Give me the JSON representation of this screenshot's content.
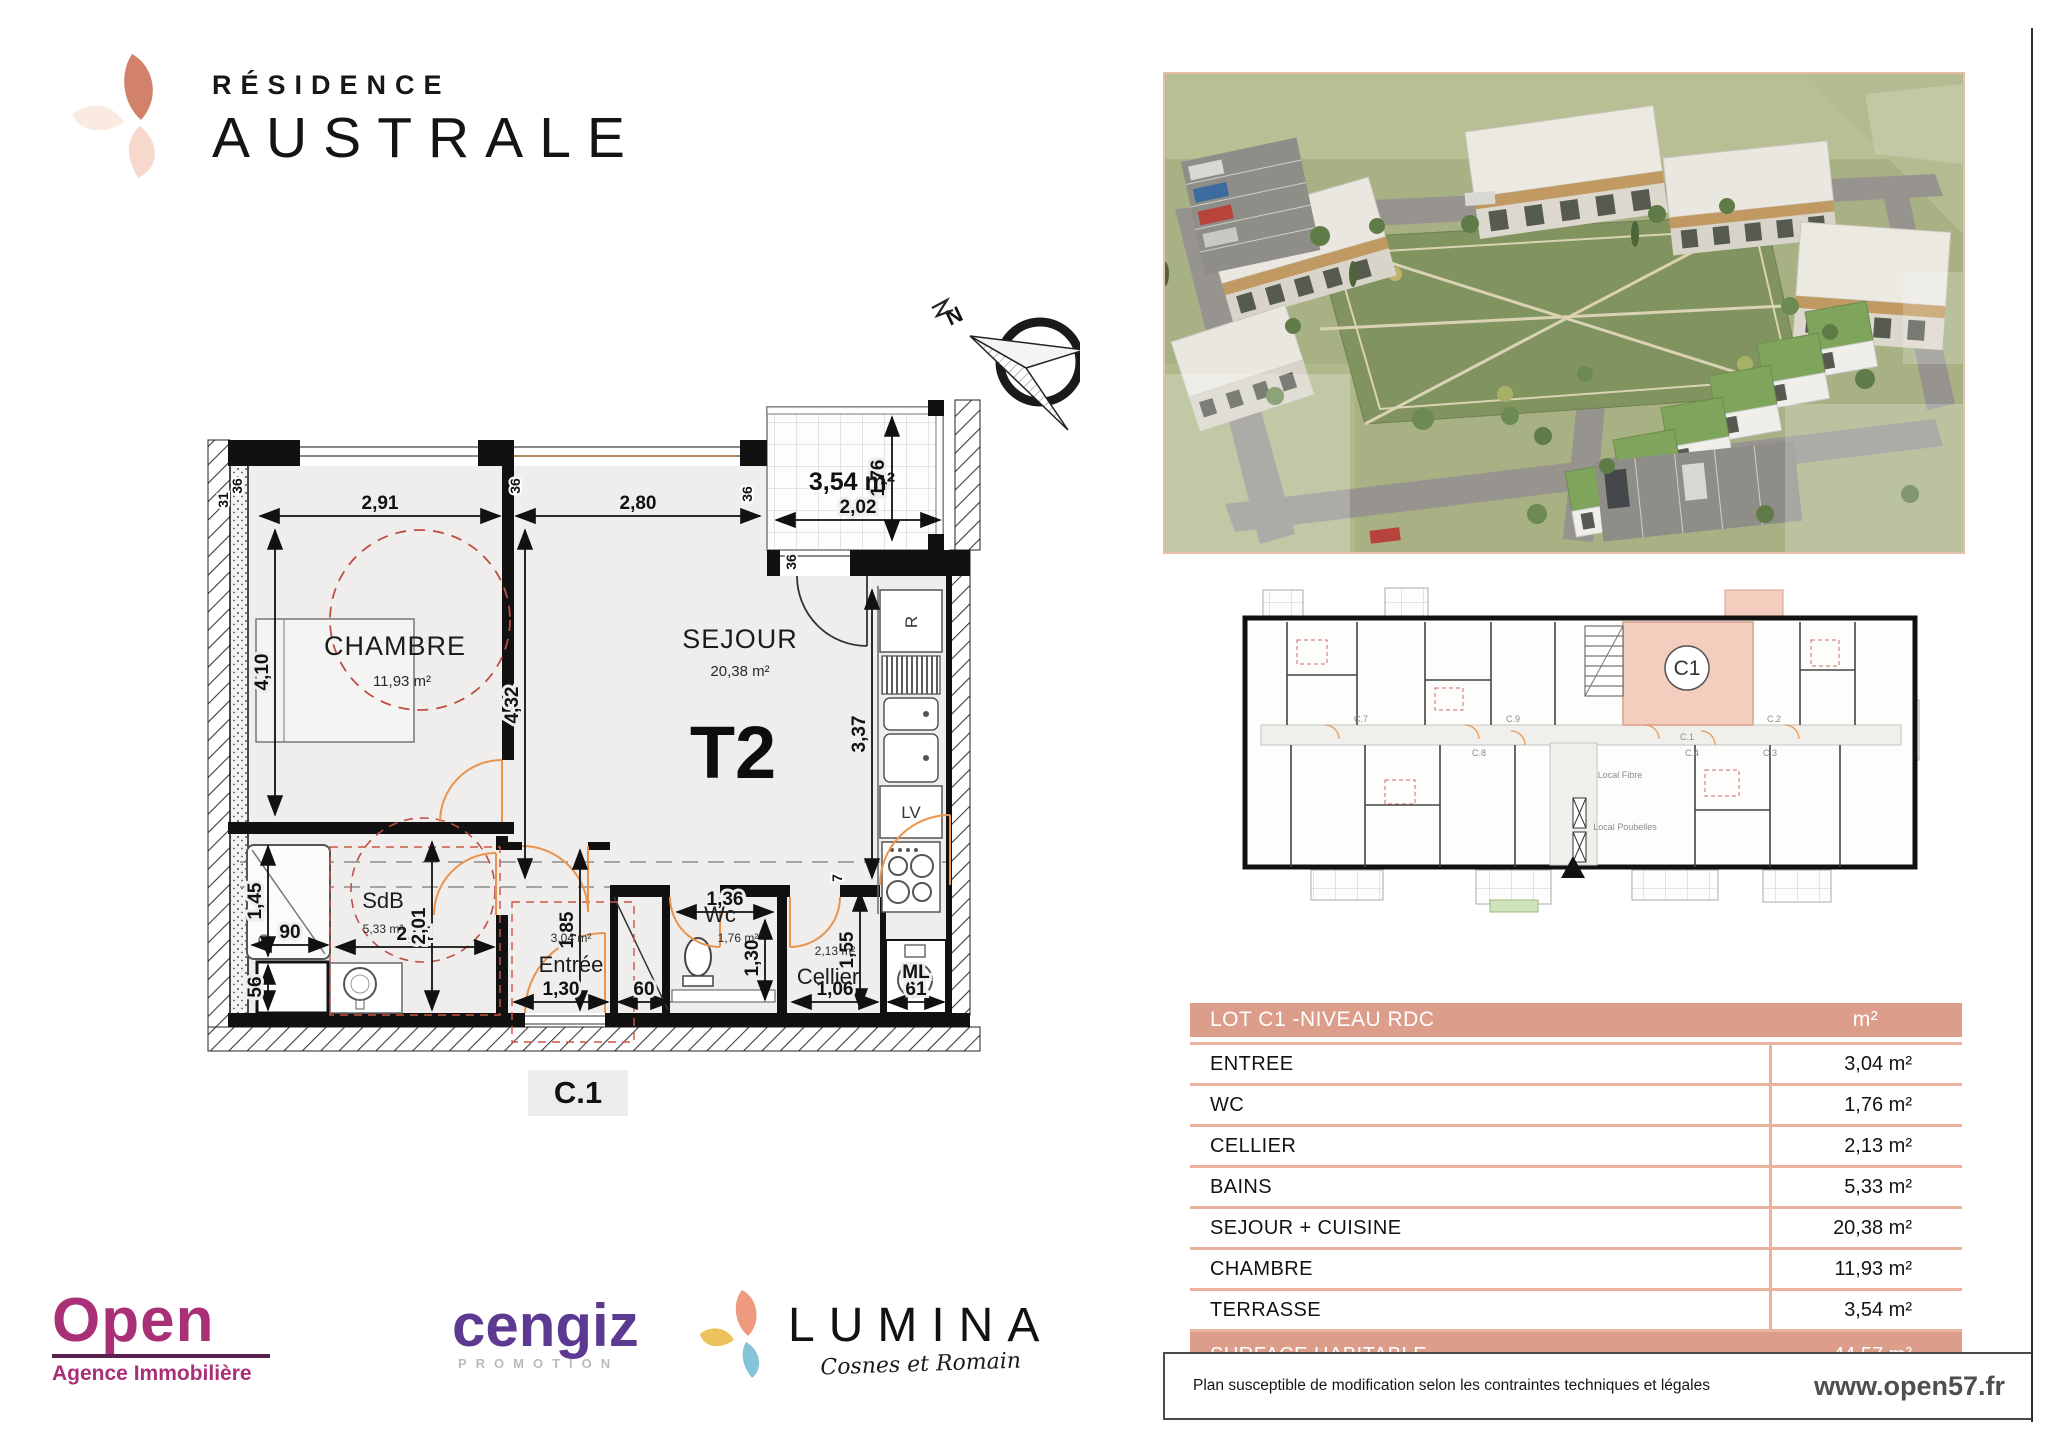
{
  "brand": {
    "line1": "RÉSIDENCE",
    "line2": "AUSTRALE"
  },
  "fp": {
    "compassN": "N",
    "t2": "T2",
    "c1": "C.1",
    "chambre": "CHAMBRE",
    "chambreArea": "11,93 m²",
    "sejour": "SEJOUR",
    "sejourArea": "20,38 m²",
    "sdb": "SdB",
    "sdbArea": "5,33 m²",
    "entree": "Entrée",
    "entreeArea": "3,04 m²",
    "wc": "Wc",
    "wcArea": "1,76 m²",
    "cellier": "Cellier",
    "cellierArea": "2,13 m²",
    "terrasseArea": "3,54 m²",
    "r": "R",
    "lv": "LV",
    "ml": "ML",
    "d291": "2,91",
    "d280": "2,80",
    "d202": "2,02",
    "d176": "1,76",
    "d410": "4,10",
    "d432": "4,32",
    "d337": "3,37",
    "d145": "1,45",
    "d90": "90",
    "d56": "56",
    "d201a": "2,01",
    "d201b": "2,01",
    "d185": "1,85",
    "d130a": "1,30",
    "d60": "60",
    "d136": "1,36",
    "d130b": "1,30",
    "d155": "1,55",
    "d106": "1,06",
    "d61": "61",
    "d36a": "36",
    "d36b": "36",
    "d36c": "36",
    "d36d": "36",
    "d31": "31",
    "d7": "7"
  },
  "sp": {
    "c1": "C1",
    "c1s": "C.1",
    "c2": "C.2",
    "c3": "C.3",
    "c4": "C.4",
    "c7": "C.7",
    "c8": "C.8",
    "c9": "C.9",
    "fibre": "Local Fibre",
    "poubelles": "Local Poubelles"
  },
  "table": {
    "header": {
      "title": "LOT C1  -NIVEAU RDC",
      "unit": "m²"
    },
    "rows": [
      {
        "label": "ENTREE",
        "value": "3,04 m²"
      },
      {
        "label": "WC",
        "value": "1,76 m²"
      },
      {
        "label": "CELLIER",
        "value": "2,13 m²"
      },
      {
        "label": "BAINS",
        "value": "5,33 m²"
      },
      {
        "label": "SEJOUR + CUISINE",
        "value": "20,38 m²"
      },
      {
        "label": "CHAMBRE",
        "value": "11,93 m²"
      },
      {
        "label": "TERRASSE",
        "value": "3,54 m²"
      }
    ],
    "footer": {
      "label": "SURFACE HABITABLE",
      "value": "44,57 m²"
    }
  },
  "partners": {
    "open": {
      "name": "Open",
      "sub": "Agence Immobilière"
    },
    "cengiz": {
      "name": "cengiz",
      "sub": "PROMOTION"
    },
    "lumina": {
      "name": "LUMINA",
      "sub": "Cosnes et Romain"
    }
  },
  "foot": {
    "disclaimer": "Plan susceptible de modification selon les contraintes techniques et légales",
    "website": "www.open57.fr"
  },
  "colors": {
    "salmon": "#dc9e8a",
    "salmonLight": "#f3cdbd",
    "tableBorder": "#eab19d"
  }
}
